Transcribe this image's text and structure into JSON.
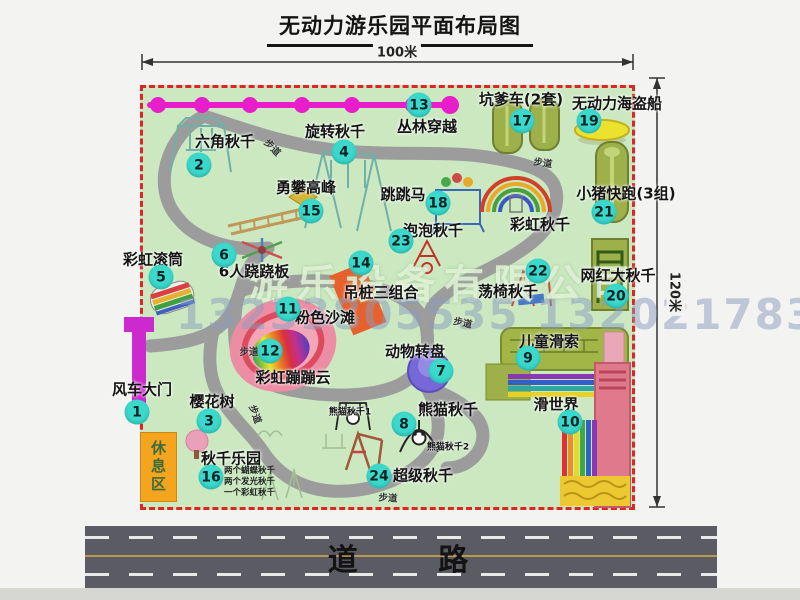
{
  "title": "无动力游乐园平面布局图",
  "dimension_labels": {
    "width": "100米",
    "height": "120米"
  },
  "road_label": "道 路",
  "rest_area_label": "休息区",
  "watermark": {
    "company": "游乐设备有限公司",
    "phone": "13233805535 13202178333"
  },
  "walkway_label": "步道",
  "walkway_positions": [
    {
      "x": 273,
      "y": 147,
      "rot": 45
    },
    {
      "x": 543,
      "y": 162,
      "rot": 8
    },
    {
      "x": 249,
      "y": 351,
      "rot": 0
    },
    {
      "x": 256,
      "y": 414,
      "rot": 70
    },
    {
      "x": 463,
      "y": 322,
      "rot": 12
    },
    {
      "x": 388,
      "y": 497,
      "rot": 4
    }
  ],
  "attractions": [
    {
      "num": "1",
      "name": "风车大门",
      "label_x": 142,
      "label_y": 389,
      "badge_x": 137,
      "badge_y": 412
    },
    {
      "num": "2",
      "name": "六角秋千",
      "label_x": 225,
      "label_y": 141,
      "badge_x": 199,
      "badge_y": 165
    },
    {
      "num": "3",
      "name": "樱花树",
      "label_x": 212,
      "label_y": 401,
      "badge_x": 209,
      "badge_y": 421
    },
    {
      "num": "4",
      "name": "旋转秋千",
      "label_x": 335,
      "label_y": 131,
      "badge_x": 344,
      "badge_y": 152
    },
    {
      "num": "5",
      "name": "彩虹滚筒",
      "label_x": 153,
      "label_y": 259,
      "badge_x": 161,
      "badge_y": 277
    },
    {
      "num": "6",
      "name": "6人跷跷板",
      "label_x": 254,
      "label_y": 271,
      "badge_x": 224,
      "badge_y": 255
    },
    {
      "num": "7",
      "name": "动物转盘",
      "label_x": 415,
      "label_y": 351,
      "badge_x": 441,
      "badge_y": 371
    },
    {
      "num": "8",
      "name": "熊猫秋千",
      "label_x": 448,
      "label_y": 409,
      "badge_x": 404,
      "badge_y": 424
    },
    {
      "num": "9",
      "name": "儿童滑索",
      "label_x": 549,
      "label_y": 341,
      "badge_x": 528,
      "badge_y": 358
    },
    {
      "num": "10",
      "name": "滑世界",
      "label_x": 556,
      "label_y": 404,
      "badge_x": 570,
      "badge_y": 422
    },
    {
      "num": "11",
      "name": "粉色沙滩",
      "label_x": 325,
      "label_y": 317,
      "badge_x": 288,
      "badge_y": 309
    },
    {
      "num": "12",
      "name": "彩虹蹦蹦云",
      "label_x": 293,
      "label_y": 377,
      "badge_x": 270,
      "badge_y": 351
    },
    {
      "num": "13",
      "name": "丛林穿越",
      "label_x": 427,
      "label_y": 126,
      "badge_x": 419,
      "badge_y": 105
    },
    {
      "num": "14",
      "name": "吊桩三组合",
      "label_x": 381,
      "label_y": 292,
      "badge_x": 361,
      "badge_y": 263
    },
    {
      "num": "15",
      "name": "勇攀高峰",
      "label_x": 306,
      "label_y": 187,
      "badge_x": 311,
      "badge_y": 211
    },
    {
      "num": "16",
      "name": "秋千乐园",
      "label_x": 231,
      "label_y": 458,
      "badge_x": 211,
      "badge_y": 477,
      "sub_labels": [
        "两个蝴蝶秋千",
        "两个发光秋千",
        "一个彩虹秋千"
      ],
      "sub_x": 224,
      "sub_y": 466
    },
    {
      "num": "17",
      "name": "坑爹车(2套)",
      "label_x": 521,
      "label_y": 99,
      "badge_x": 522,
      "badge_y": 121
    },
    {
      "num": "18",
      "name": "跳跳马",
      "label_x": 403,
      "label_y": 194,
      "badge_x": 438,
      "badge_y": 203
    },
    {
      "num": "19",
      "name": "无动力海盗船",
      "label_x": 617,
      "label_y": 103,
      "badge_x": 589,
      "badge_y": 121
    },
    {
      "num": "20",
      "name": "网红大秋千",
      "label_x": 618,
      "label_y": 275,
      "badge_x": 616,
      "badge_y": 296
    },
    {
      "num": "21",
      "name": "小猪快跑(3组)",
      "label_x": 626,
      "label_y": 193,
      "badge_x": 604,
      "badge_y": 212
    },
    {
      "num": "22",
      "name": "荡椅秋千",
      "label_x": 508,
      "label_y": 291,
      "badge_x": 538,
      "badge_y": 271
    },
    {
      "num": "23",
      "name": "泡泡秋千",
      "label_x": 433,
      "label_y": 230,
      "badge_x": 401,
      "badge_y": 241
    },
    {
      "num": "24",
      "name": "超级秋千",
      "label_x": 423,
      "label_y": 475,
      "badge_x": 379,
      "badge_y": 476
    }
  ],
  "extra_labels": [
    {
      "text": "彩虹秋千",
      "x": 540,
      "y": 224,
      "small": false
    },
    {
      "text": "熊猫秋千1",
      "x": 350,
      "y": 411,
      "small": true
    },
    {
      "text": "熊猫秋千2",
      "x": 448,
      "y": 446,
      "small": true
    }
  ],
  "colors": {
    "badge": "#3bd8cc",
    "map_border": "#e02424",
    "map_bg": "#cbe8c1",
    "zipline": "#e81ecb",
    "road": "#5b5b63",
    "road_center_line": "#b89a4a",
    "rest_area": "#f5a41e"
  }
}
